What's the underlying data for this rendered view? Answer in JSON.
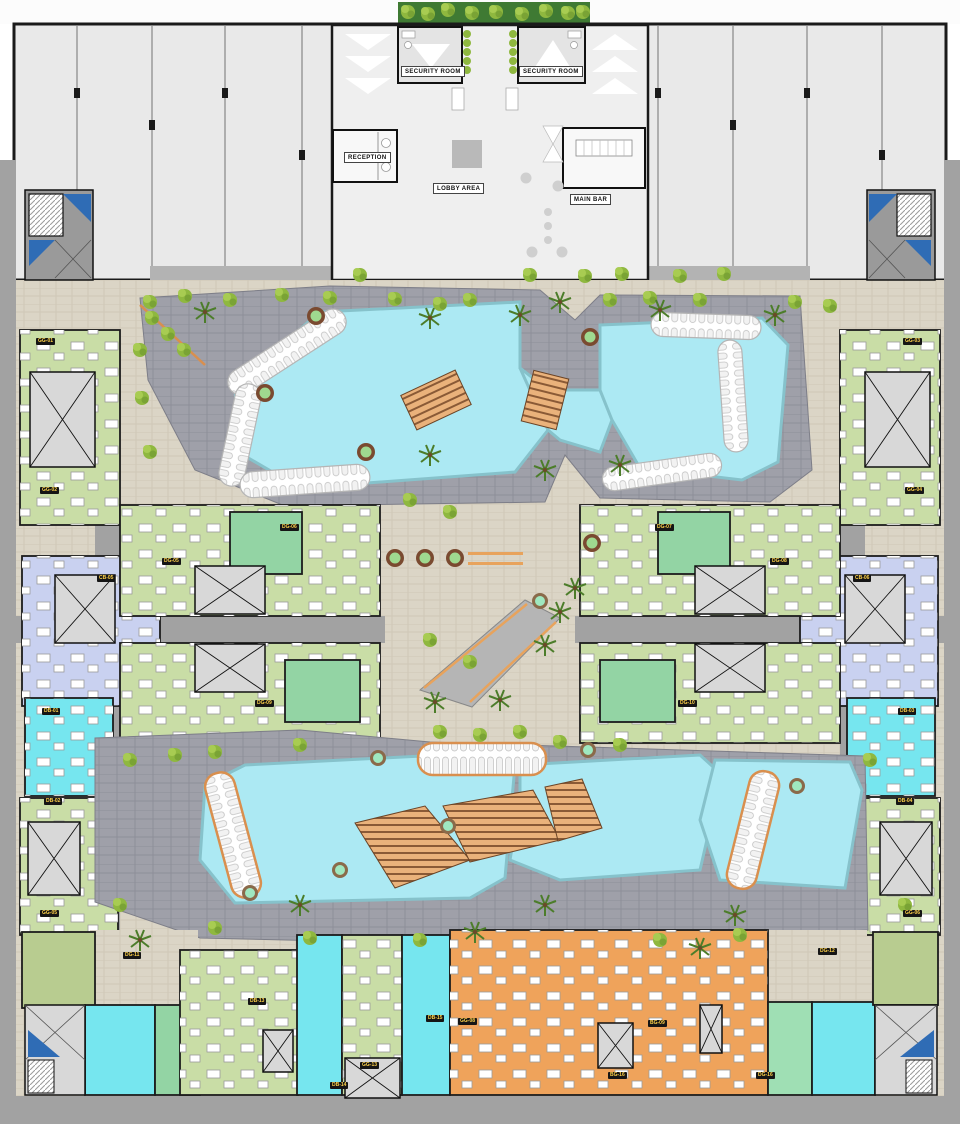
{
  "plan_title": "resort-ground-floor-site-plan",
  "facilities": {
    "security_room_left": "SECURITY ROOM",
    "security_room_right": "SECURITY ROOM",
    "reception": "RECEPTION",
    "lobby": "LOBBY AREA",
    "main_bar": "MAIN BAR"
  },
  "colors": {
    "shell": "#e9e9e9",
    "road": "#a2a2a2",
    "plaza": "#dbd5c6",
    "deck": "#9fa0a9",
    "pool": "#ace9f3",
    "pool-edge": "#86c2cb",
    "unit-green-light": "#c9dda6",
    "unit-green-med": "#93d4a4",
    "unit-mint": "#9fdfb4",
    "unit-cyan": "#76e6ef",
    "unit-orange": "#efa35b",
    "unit-lavender": "#c9d1f0",
    "unit-olive": "#b8cc90",
    "wood": "#eab27b",
    "stair-blue": "#2f6cb5",
    "hedge": "#3f7a33",
    "badge-bg": "#151515",
    "badge-text": "#ffd24a"
  },
  "unit_badges": [
    {
      "code": "GG-01",
      "x": 36,
      "y": 338
    },
    {
      "code": "GG-02",
      "x": 40,
      "y": 487
    },
    {
      "code": "GG-03",
      "x": 903,
      "y": 338
    },
    {
      "code": "GG-04",
      "x": 905,
      "y": 487
    },
    {
      "code": "CB-05",
      "x": 97,
      "y": 575
    },
    {
      "code": "CB-06",
      "x": 853,
      "y": 575
    },
    {
      "code": "DG-05",
      "x": 162,
      "y": 558
    },
    {
      "code": "DG-06",
      "x": 280,
      "y": 524
    },
    {
      "code": "DG-07",
      "x": 655,
      "y": 524
    },
    {
      "code": "DG-08",
      "x": 770,
      "y": 558
    },
    {
      "code": "DG-09",
      "x": 255,
      "y": 700
    },
    {
      "code": "DG-10",
      "x": 678,
      "y": 700
    },
    {
      "code": "DB-01",
      "x": 42,
      "y": 708
    },
    {
      "code": "DB-02",
      "x": 44,
      "y": 798
    },
    {
      "code": "DB-03",
      "x": 898,
      "y": 708
    },
    {
      "code": "DB-04",
      "x": 896,
      "y": 798
    },
    {
      "code": "GG-05",
      "x": 40,
      "y": 910
    },
    {
      "code": "GG-06",
      "x": 903,
      "y": 910
    },
    {
      "code": "DG-11",
      "x": 123,
      "y": 952
    },
    {
      "code": "DG-12",
      "x": 818,
      "y": 948
    },
    {
      "code": "DB-13",
      "x": 248,
      "y": 998
    },
    {
      "code": "DB-14",
      "x": 330,
      "y": 1082
    },
    {
      "code": "DB-15",
      "x": 426,
      "y": 1015
    },
    {
      "code": "GG-13",
      "x": 360,
      "y": 1062
    },
    {
      "code": "GG-08",
      "x": 458,
      "y": 1018
    },
    {
      "code": "BG-09",
      "x": 648,
      "y": 1020
    },
    {
      "code": "BG-16",
      "x": 608,
      "y": 1072
    },
    {
      "code": "DG-16",
      "x": 756,
      "y": 1072
    }
  ]
}
